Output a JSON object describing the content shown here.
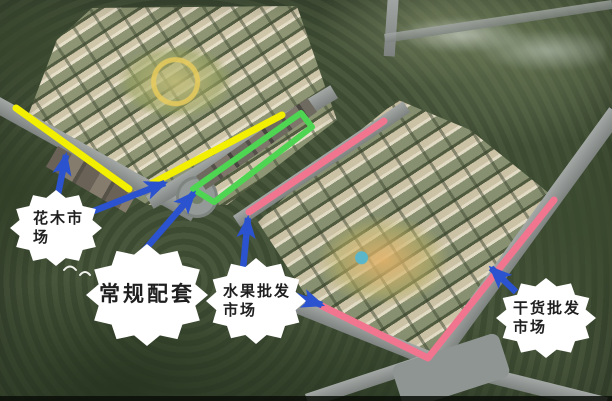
{
  "callouts": {
    "flower_market": {
      "label": "花木市场"
    },
    "standard_facilities": {
      "label": "常规配套"
    },
    "fruit_wholesale_market": {
      "label": "水果批发市场"
    },
    "dried_goods_wholesale_market": {
      "label": "干货批发市场"
    }
  },
  "annotations": {
    "colors": {
      "route_yellow": "#f2ef00",
      "route_green": "#4ed653",
      "route_pink": "#f2758f",
      "arrow_blue": "#2b52cf"
    }
  }
}
